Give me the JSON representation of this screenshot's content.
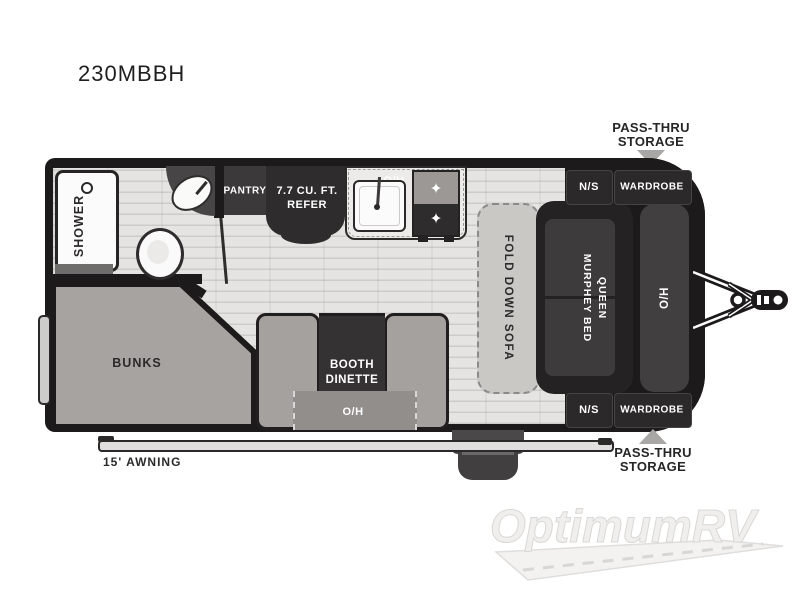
{
  "title": "230MBBH",
  "callouts": {
    "pass_thru_line1": "PASS-THRU",
    "pass_thru_line2": "STORAGE",
    "awning": "15' AWNING"
  },
  "labels": {
    "shower": "SHOWER",
    "pantry": "PANTRY",
    "refer_line1": "7.7 CU. FT.",
    "refer_line2": "REFER",
    "kitchen_overhead": "O/H",
    "bunks": "BUNKS",
    "booth_line1": "BOOTH",
    "booth_line2": "DINETTE",
    "dinette_overhead": "O/H",
    "fold_down_sofa": "FOLD DOWN SOFA",
    "murphy_line1": "QUEEN",
    "murphy_line2": "MURPHEY BED",
    "nightstand_top": "N/S",
    "wardrobe_top": "WARDROBE",
    "nightstand_bottom": "N/S",
    "wardrobe_bottom": "WARDROBE",
    "front_overhead": "O/H"
  },
  "icons": {
    "burner": "✦"
  },
  "watermark": "OptimumRV",
  "colors": {
    "wall": "#1c1a1a",
    "dark_furniture": "#2e2c2d",
    "floor": "#e5e4e2",
    "soft_gray": "#a5a29f",
    "arrow_gray": "#a9a7a5"
  }
}
